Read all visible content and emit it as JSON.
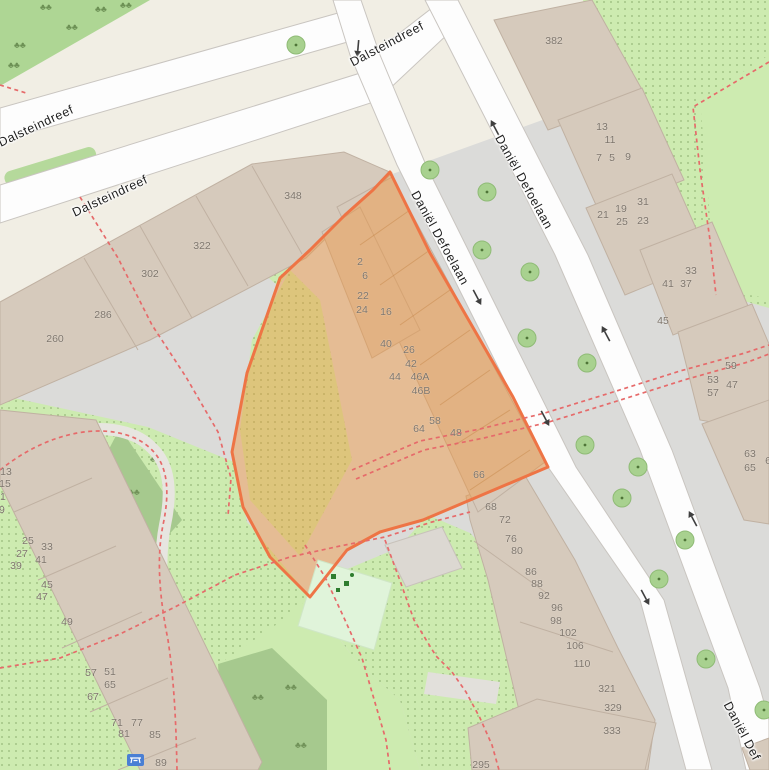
{
  "map": {
    "title": "Map view of Dalsteindreef / Daniël Defoelaan area with highlighted parcel",
    "street_labels": [
      {
        "text": "Dalsteindreef",
        "x": 36,
        "y": 126,
        "rot": -25
      },
      {
        "text": "Dalsteindreef",
        "x": 110,
        "y": 196,
        "rot": -25
      },
      {
        "text": "Dalsteindreef",
        "x": 387,
        "y": 44,
        "rot": -28
      },
      {
        "text": "Daniël Defoelaan",
        "x": 524,
        "y": 182,
        "rot": 61
      },
      {
        "text": "Daniël Defoelaan",
        "x": 440,
        "y": 238,
        "rot": 61
      },
      {
        "text": "Daniël Def",
        "x": 742,
        "y": 731,
        "rot": 62
      }
    ],
    "house_numbers": [
      {
        "t": "348",
        "x": 293,
        "y": 196
      },
      {
        "t": "322",
        "x": 202,
        "y": 246
      },
      {
        "t": "302",
        "x": 150,
        "y": 274
      },
      {
        "t": "286",
        "x": 103,
        "y": 315
      },
      {
        "t": "260",
        "x": 55,
        "y": 339
      },
      {
        "t": "2",
        "x": 360,
        "y": 262
      },
      {
        "t": "6",
        "x": 365,
        "y": 276
      },
      {
        "t": "22",
        "x": 363,
        "y": 296
      },
      {
        "t": "24",
        "x": 362,
        "y": 310
      },
      {
        "t": "16",
        "x": 386,
        "y": 312
      },
      {
        "t": "40",
        "x": 386,
        "y": 344
      },
      {
        "t": "26",
        "x": 409,
        "y": 350
      },
      {
        "t": "42",
        "x": 411,
        "y": 364
      },
      {
        "t": "44",
        "x": 395,
        "y": 377
      },
      {
        "t": "46A",
        "x": 420,
        "y": 377
      },
      {
        "t": "46B",
        "x": 421,
        "y": 391
      },
      {
        "t": "64",
        "x": 419,
        "y": 429
      },
      {
        "t": "58",
        "x": 435,
        "y": 421
      },
      {
        "t": "48",
        "x": 456,
        "y": 433
      },
      {
        "t": "66",
        "x": 479,
        "y": 475
      },
      {
        "t": "68",
        "x": 491,
        "y": 507
      },
      {
        "t": "72",
        "x": 505,
        "y": 520
      },
      {
        "t": "76",
        "x": 511,
        "y": 539
      },
      {
        "t": "80",
        "x": 517,
        "y": 551
      },
      {
        "t": "86",
        "x": 531,
        "y": 572
      },
      {
        "t": "88",
        "x": 537,
        "y": 584
      },
      {
        "t": "92",
        "x": 544,
        "y": 596
      },
      {
        "t": "96",
        "x": 557,
        "y": 608
      },
      {
        "t": "98",
        "x": 556,
        "y": 621
      },
      {
        "t": "102",
        "x": 568,
        "y": 633
      },
      {
        "t": "106",
        "x": 575,
        "y": 646
      },
      {
        "t": "110",
        "x": 582,
        "y": 664
      },
      {
        "t": "321",
        "x": 607,
        "y": 689
      },
      {
        "t": "329",
        "x": 613,
        "y": 708
      },
      {
        "t": "333",
        "x": 612,
        "y": 731
      },
      {
        "t": "295",
        "x": 481,
        "y": 765
      },
      {
        "t": "382",
        "x": 554,
        "y": 41
      },
      {
        "t": "13",
        "x": 602,
        "y": 127
      },
      {
        "t": "11",
        "x": 610,
        "y": 140
      },
      {
        "t": "7",
        "x": 599,
        "y": 158
      },
      {
        "t": "5",
        "x": 612,
        "y": 158
      },
      {
        "t": "9",
        "x": 628,
        "y": 157
      },
      {
        "t": "21",
        "x": 603,
        "y": 215
      },
      {
        "t": "19",
        "x": 621,
        "y": 209
      },
      {
        "t": "31",
        "x": 643,
        "y": 202
      },
      {
        "t": "25",
        "x": 622,
        "y": 222
      },
      {
        "t": "23",
        "x": 643,
        "y": 221
      },
      {
        "t": "33",
        "x": 691,
        "y": 271
      },
      {
        "t": "41",
        "x": 668,
        "y": 284
      },
      {
        "t": "37",
        "x": 686,
        "y": 284
      },
      {
        "t": "45",
        "x": 663,
        "y": 321
      },
      {
        "t": "59",
        "x": 731,
        "y": 366
      },
      {
        "t": "53",
        "x": 713,
        "y": 380
      },
      {
        "t": "47",
        "x": 732,
        "y": 385
      },
      {
        "t": "57",
        "x": 713,
        "y": 393
      },
      {
        "t": "63",
        "x": 750,
        "y": 454
      },
      {
        "t": "65",
        "x": 750,
        "y": 468
      },
      {
        "t": "6",
        "x": 768,
        "y": 461
      },
      {
        "t": "13",
        "x": 6,
        "y": 472
      },
      {
        "t": "15",
        "x": 5,
        "y": 484
      },
      {
        "t": "21",
        "x": 0,
        "y": 497
      },
      {
        "t": "19",
        "x": -1,
        "y": 510
      },
      {
        "t": "25",
        "x": 28,
        "y": 541
      },
      {
        "t": "27",
        "x": 22,
        "y": 554
      },
      {
        "t": "33",
        "x": 47,
        "y": 547
      },
      {
        "t": "41",
        "x": 41,
        "y": 560
      },
      {
        "t": "39",
        "x": 16,
        "y": 566
      },
      {
        "t": "45",
        "x": 47,
        "y": 585
      },
      {
        "t": "47",
        "x": 42,
        "y": 597
      },
      {
        "t": "49",
        "x": 67,
        "y": 622
      },
      {
        "t": "57",
        "x": 91,
        "y": 673
      },
      {
        "t": "51",
        "x": 110,
        "y": 672
      },
      {
        "t": "65",
        "x": 110,
        "y": 685
      },
      {
        "t": "67",
        "x": 93,
        "y": 697
      },
      {
        "t": "71",
        "x": 117,
        "y": 723
      },
      {
        "t": "77",
        "x": 137,
        "y": 723
      },
      {
        "t": "81",
        "x": 124,
        "y": 734
      },
      {
        "t": "85",
        "x": 155,
        "y": 735
      },
      {
        "t": "89",
        "x": 161,
        "y": 763
      }
    ],
    "trees": [
      [
        296,
        45
      ],
      [
        430,
        170
      ],
      [
        487,
        192
      ],
      [
        482,
        250
      ],
      [
        530,
        272
      ],
      [
        527,
        338
      ],
      [
        587,
        363
      ],
      [
        585,
        445
      ],
      [
        638,
        467
      ],
      [
        622,
        498
      ],
      [
        685,
        540
      ],
      [
        659,
        579
      ],
      [
        706,
        659
      ],
      [
        764,
        710
      ]
    ],
    "oneway_arrows": [
      {
        "x": 358,
        "y": 48,
        "rot": 95
      },
      {
        "x": 477,
        "y": 297,
        "rot": 62
      },
      {
        "x": 545,
        "y": 418,
        "rot": 62
      },
      {
        "x": 645,
        "y": 597,
        "rot": 62
      },
      {
        "x": 495,
        "y": 128,
        "rot": 242
      },
      {
        "x": 606,
        "y": 334,
        "rot": 242
      },
      {
        "x": 693,
        "y": 519,
        "rot": 242
      }
    ],
    "icons": {
      "tree": "tree-icon",
      "oneway": "oneway-arrow-icon",
      "playground": "playground-equipment-icon",
      "amenity_sign": "picnic-table-icon"
    },
    "palette": {
      "highlight_fill": "#f49235",
      "highlight_border": "#ee7445",
      "road": "#ffffff",
      "residential_gray": "#dbdbd9",
      "pedestrian_beige": "#f1eee4",
      "building": "#d6cabc",
      "grass": "#cdebb0",
      "forest": "#a6c98e",
      "playground_green": "#e0f4da",
      "path_dash_red": "#e66a6a",
      "amenity_blue": "#4a7fd4"
    }
  }
}
